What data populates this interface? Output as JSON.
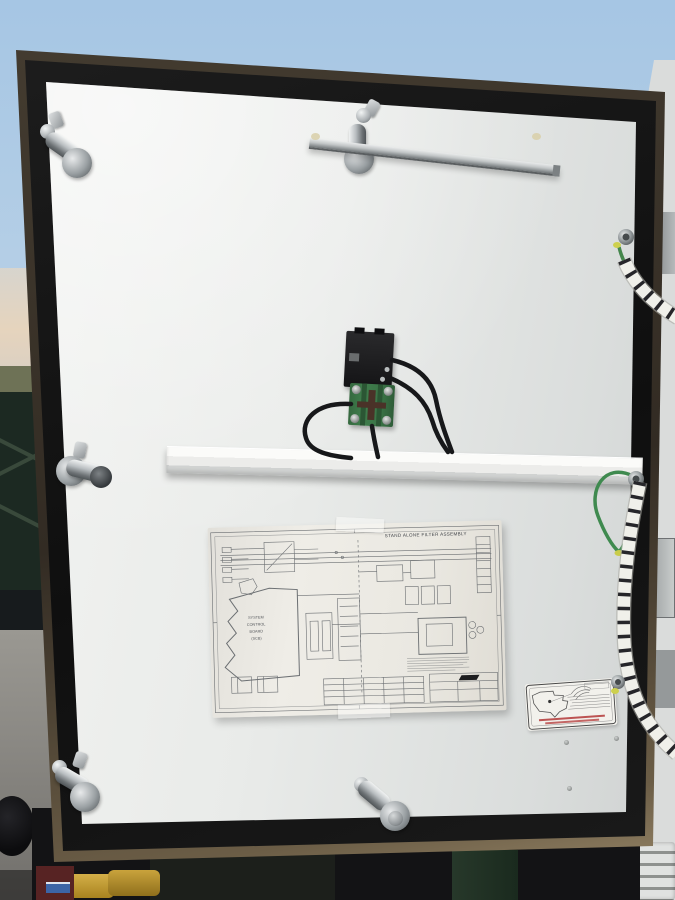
{
  "schematic": {
    "title": "STAND ALONE FILTER ASSEMBLY",
    "scb_lines": [
      "SYSTEM",
      "CONTROL",
      "BOARD",
      "(SCB)"
    ]
  },
  "colors": {
    "sky_top": "#a6c6e4",
    "sky_horizon": "#e8e0d2",
    "door_face": "#e9ebe9",
    "gasket_black": "#141414",
    "frame_metal_tan": "#8a7a5e",
    "chrome": "#aeb3b6",
    "terminal_green": "#3f7d4c",
    "ground_wire_green": "#44864c",
    "spiral_wrap_white": "#f0f0ea",
    "connector_black": "#1b1b1d",
    "cabinet_side": "#d5d8d6",
    "machinery_dark": "#131315",
    "concrete_gray": "#8b8984",
    "yellow_connector": "#c9a33c"
  },
  "icons": {
    "sticker": "made-in-usa-map-eagle-label"
  }
}
